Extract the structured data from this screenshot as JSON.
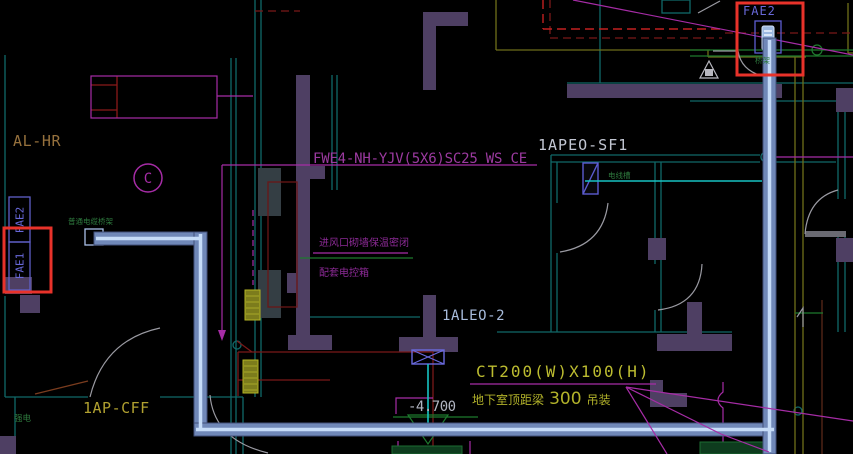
{
  "drawing": {
    "labels": {
      "fae2_top": "FAE2",
      "fae2_left": "FAE2",
      "fae1_left": "FAE1",
      "al_hr": "AL-HR",
      "grid_bubble": "C",
      "cable_spec": "FWE4-NH-YJV(5X6)SC25 WS CE",
      "panel_sf1": "1APEO-SF1",
      "panel_aleo": "1ALEO-2",
      "tray_size": "CT200(W)X100(H)",
      "install_note_prefix": "地下室顶距梁",
      "install_note_value": "300",
      "install_note_suffix": "吊装",
      "elevation": "-4.700",
      "panel_cff": "1AP-CFF",
      "vent_note_line1": "进风口砌墙保温密闭",
      "vent_note_line2": "配套电控箱",
      "tray_note_left": "普通电缆桥架",
      "wire_note_mid": "电线槽",
      "wire_note_top": "桥架",
      "room_note": "强电"
    },
    "colors": {
      "background": "#000000",
      "highlight_red": "#e8322a",
      "tray_fill": "#7088b8",
      "tray_core": "#c6dcf8",
      "device_blue": "#5c5cd0",
      "wall_purple": "#4e3f63",
      "wall_teal": "#106868",
      "annotation_magenta": "#a62ca6",
      "text_magenta": "#9c3aa0",
      "wire_dark_red": "#7a1818",
      "dashed_red": "#c22020",
      "circuit_cyan": "#17c3c3",
      "note_yellow": "#bcbc30",
      "line_olive": "#6e6e1a",
      "green": "#1e7a2e",
      "door_grey": "#9a9aa2",
      "text_grey": "#b2b6c2"
    }
  }
}
